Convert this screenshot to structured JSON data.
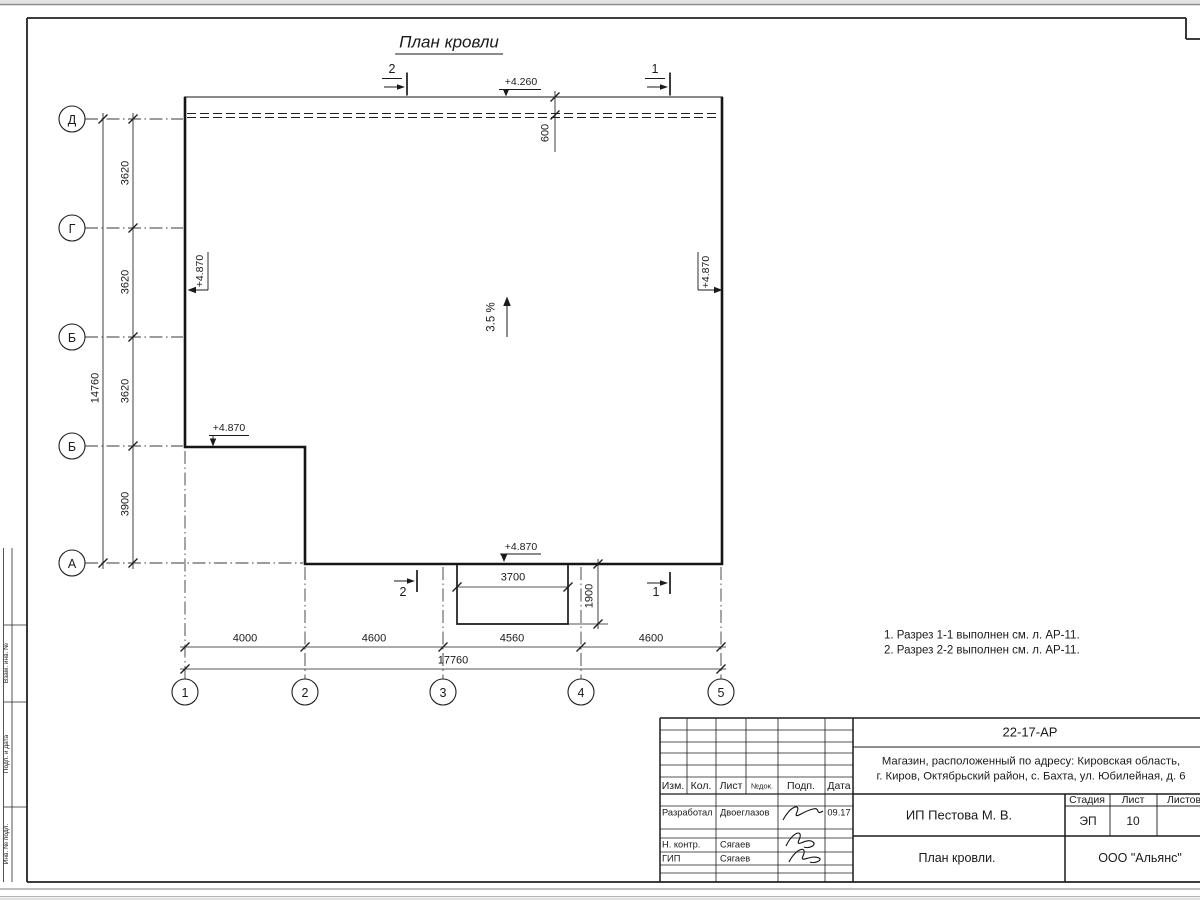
{
  "title": "План кровли",
  "axes": {
    "rows": [
      "Д",
      "Г",
      "Б",
      "Б",
      "А"
    ],
    "cols": [
      "1",
      "2",
      "3",
      "4",
      "5"
    ]
  },
  "dims": {
    "left": [
      "3620",
      "3620",
      "3620",
      "3900"
    ],
    "left_total": "14760",
    "bottom": [
      "4000",
      "4600",
      "4560",
      "4600"
    ],
    "bottom_total": "17760",
    "canopy_width": "3700",
    "canopy_depth": "1900",
    "overhang": "600"
  },
  "elevations": {
    "eave": "+4.260",
    "left": "+4.870",
    "right": "+4.870",
    "step": "+4.870",
    "bottom": "+4.870"
  },
  "slope": "3.5 %",
  "sections": {
    "top": [
      "2",
      "1"
    ],
    "bottom": [
      "2",
      "1"
    ]
  },
  "notes": [
    "1. Разрез 1-1 выполнен см. л. АР-11.",
    "2. Разрез 2-2 выполнен см. л. АР-11."
  ],
  "stamp": {
    "code": "22-17-АР",
    "address_line1": "Магазин, расположенный по адресу: Кировская область,",
    "address_line2": "г. Киров, Октябрьский район, с. Бахта, ул. Юбилейная, д. 6",
    "client": "ИП Пестова М. В.",
    "sheet_title": "План кровли.",
    "company": "ООО \"Альянс\"",
    "stage_label": "Стадия",
    "sheet_label": "Лист",
    "sheets_label": "Листов",
    "stage": "ЭП",
    "sheet_no": "10",
    "cols": [
      "Изм.",
      "Кол.",
      "Лист",
      "№док.",
      "Подп.",
      "Дата"
    ],
    "rows": [
      {
        "role": "Разработал",
        "name": "Двоеглазов",
        "date": "09.17"
      },
      {
        "role": "Н. контр.",
        "name": "Сягаев"
      },
      {
        "role": "ГИП",
        "name": "Сягаев"
      }
    ]
  },
  "side_stamp": {
    "labels": [
      "Взам. инв. №",
      "Подп. и дата",
      "Инв. № подл."
    ]
  }
}
